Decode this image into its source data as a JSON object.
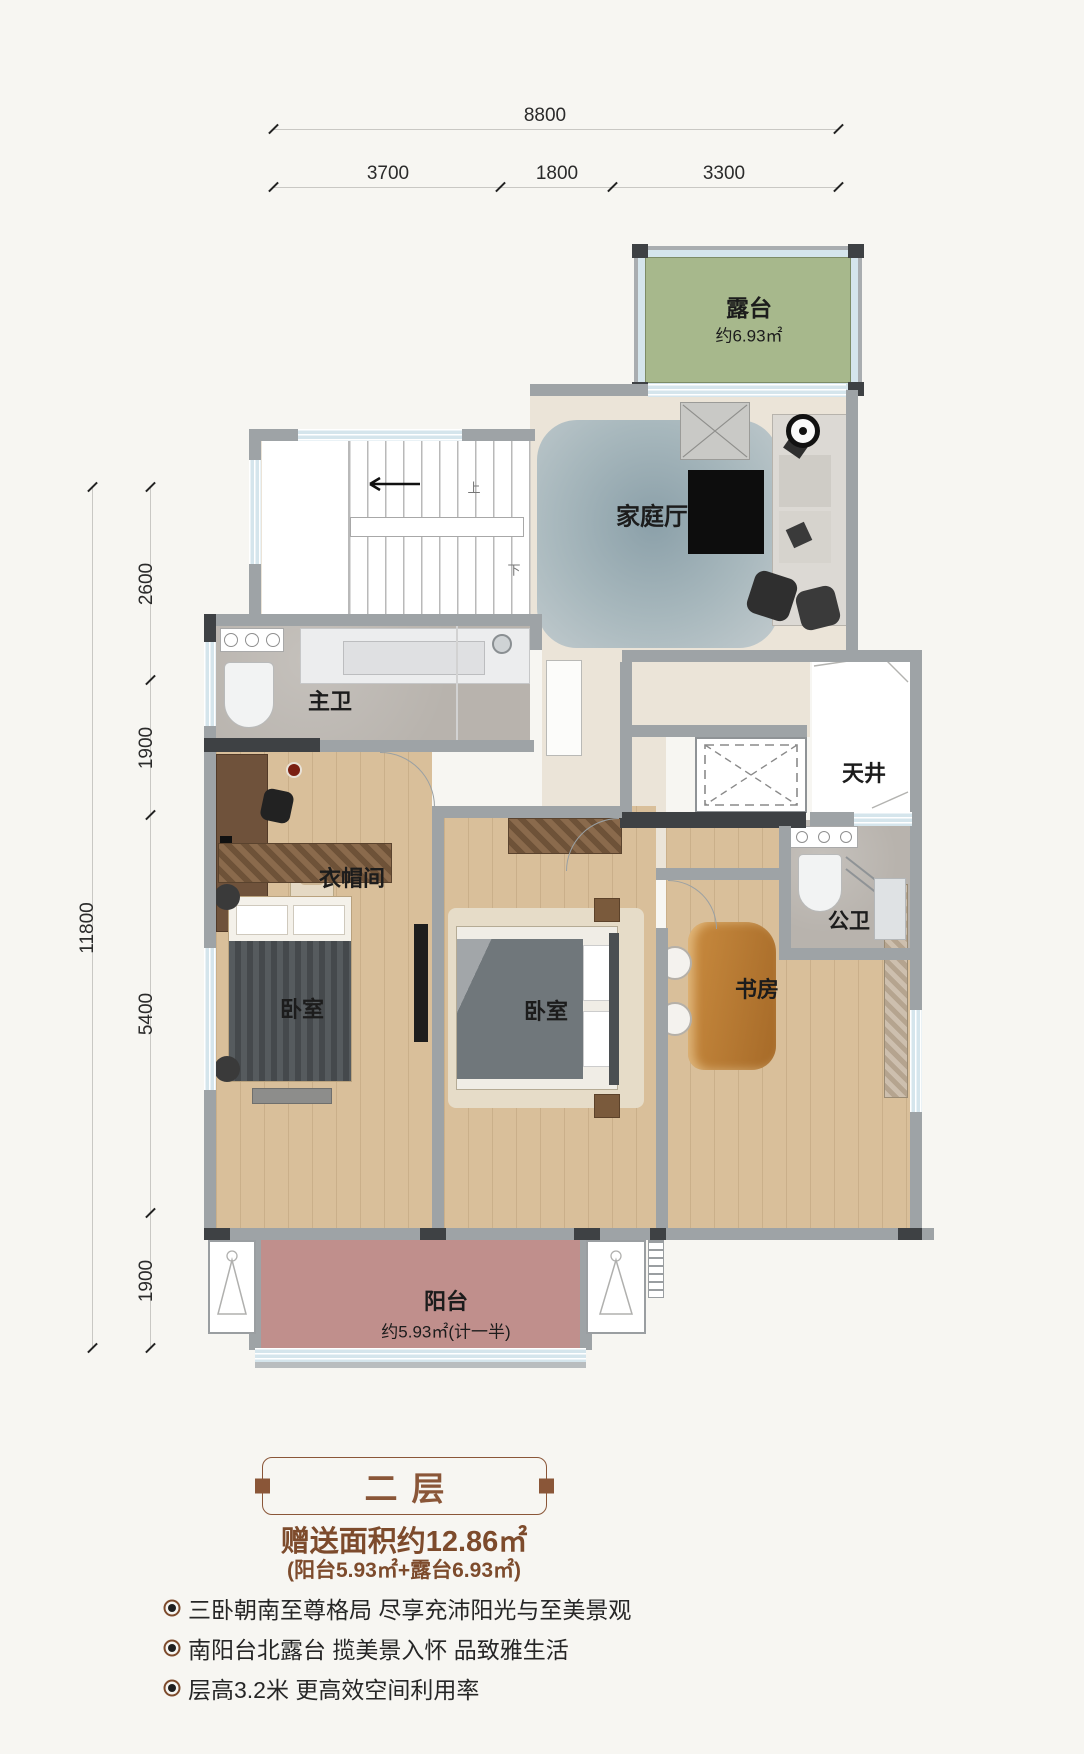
{
  "dims": {
    "top_total": "8800",
    "top_segments": [
      "3700",
      "1800",
      "3300"
    ],
    "left_total": "11800",
    "left_segments": [
      "2600",
      "1900",
      "5400",
      "1900"
    ]
  },
  "rooms": {
    "terrace": {
      "name": "露台",
      "area": "约6.93㎡"
    },
    "family_hall": {
      "name": "家庭厅"
    },
    "master_bath": {
      "name": "主卫"
    },
    "lightwell": {
      "name": "天井"
    },
    "cloakroom": {
      "name": "衣帽间"
    },
    "public_bath": {
      "name": "公卫"
    },
    "bedroom_left": {
      "name": "卧室"
    },
    "bedroom_mid": {
      "name": "卧室"
    },
    "study": {
      "name": "书房"
    },
    "balcony": {
      "name": "阳台",
      "area": "约5.93㎡(计一半)"
    }
  },
  "stairs": {
    "up": "上",
    "down": "下"
  },
  "footer": {
    "floor_title": "二层",
    "bonus_area": "赠送面积约12.86㎡",
    "bonus_detail": "(阳台5.93㎡+露台6.93㎡)",
    "bullets": [
      "三卧朝南至尊格局 尽享充沛阳光与至美景观",
      "南阳台北露台 揽美景入怀 品致雅生活",
      "层高3.2米 更高效空间利用率"
    ]
  },
  "colors": {
    "terrace_green": "#a7b88c",
    "balcony_pink": "#c08f8c",
    "glass": "#d5e5ec",
    "wall_gray": "#9ea3a6",
    "wall_dark": "#3e4144",
    "floor_beige": "#ebe4d8",
    "floor_wood": "#d9bf9a",
    "tile_gray": "#b8b3ad",
    "accent_brown": "#7d4b2c",
    "title_brown": "#8a5638"
  }
}
